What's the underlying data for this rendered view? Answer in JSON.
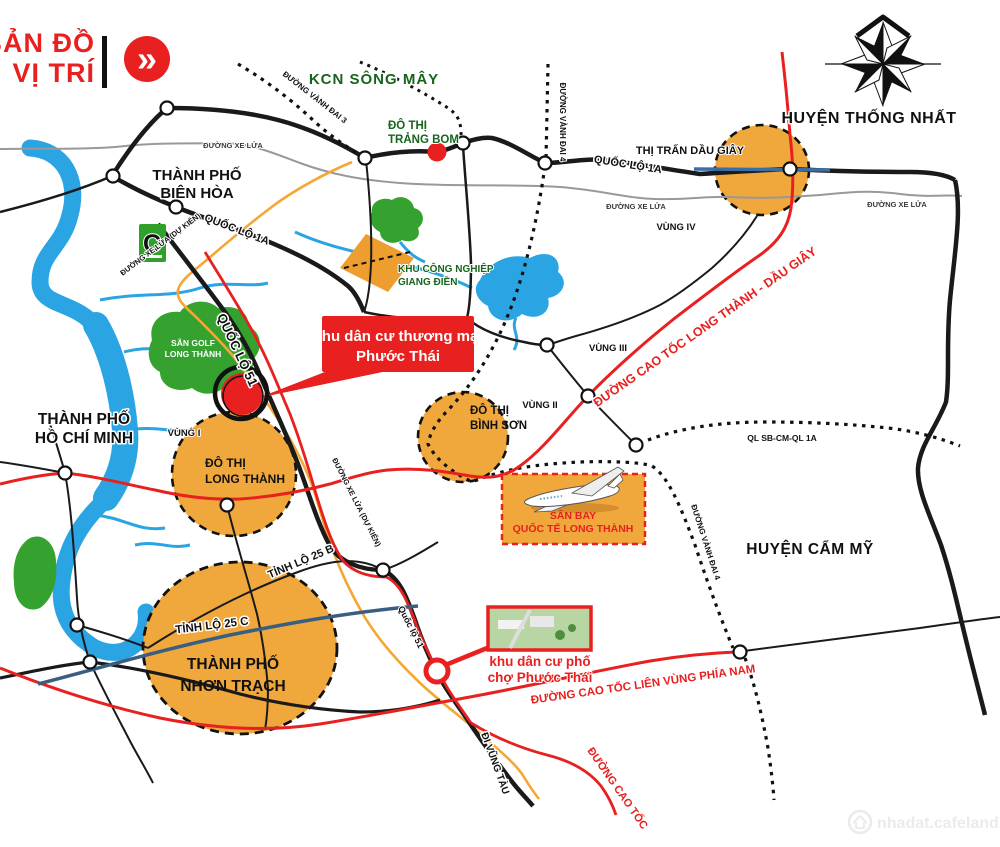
{
  "title": {
    "line1": "BẢN ĐỒ",
    "line2": "VỊ TRÍ",
    "chevron": "»"
  },
  "places": {
    "kcn_song_may": "KCN SÔNG MÂY",
    "do_thi_trang_bom_l1": "ĐÔ THỊ",
    "do_thi_trang_bom_l2": "TRẢNG BOM",
    "huyen_thong_nhat": "HUYỆN THỐNG NHẤT",
    "thi_tran_dau_giay": "THỊ TRẤN DẦU GIÂY",
    "tp_bien_hoa_l1": "THÀNH PHỐ",
    "tp_bien_hoa_l2": "BIÊN HÒA",
    "tp_hcm_l1": "THÀNH PHỐ",
    "tp_hcm_l2": "HỒ CHÍ MINH",
    "huyen_cam_my": "HUYỆN CẨM MỸ",
    "san_golf_l1": "SÂN GOLF",
    "san_golf_l2": "LONG THÀNH",
    "kcn_giang_dien_l1": "KHU CÔNG NGHIỆP",
    "kcn_giang_dien_l2": "GIANG ĐIỀN",
    "do_thi_binh_son_l1": "ĐÔ THỊ",
    "do_thi_binh_son_l2": "BÌNH SƠN",
    "do_thi_long_thanh_l1": "ĐÔ THỊ",
    "do_thi_long_thanh_l2": "LONG THÀNH",
    "tp_nhon_trach_l1": "THÀNH PHỐ",
    "tp_nhon_trach_l2": "NHƠN TRẠCH",
    "vung1": "VÙNG I",
    "vung2": "VÙNG II",
    "vung3": "VÙNG III",
    "vung4": "VÙNG IV",
    "bigc": "C"
  },
  "roads": {
    "ql1a": "QUỐC LỘ 1A",
    "ql51_big": "QUỐC LỘ 51",
    "ql51_small": "Quốc lộ 51",
    "tl25b": "TỈNH LỘ 25 B",
    "tl25c": "TỈNH LỘ 25 C",
    "vanh_dai_3": "ĐƯỜNG VÀNH ĐAI 3",
    "vanh_dai_4": "ĐƯỜNG VÀNH ĐAI 4",
    "xe_lua": "ĐƯỜNG XE LỬA",
    "xe_lua_du_kien": "ĐƯỜNG XE LỬA (DỰ KIẾN)",
    "ql_sb": "QL SB-CM-QL 1A",
    "cao_toc_ltdg": "ĐƯỜNG CAO TỐC LONG THÀNH - DẦU GIÂY",
    "cao_toc_lien_vung": "ĐƯỜNG CAO TỐC LIÊN VÙNG PHÍA NAM",
    "cao_toc": "ĐƯỜNG CAO TỐC",
    "di_vung_tau": "ĐI VŨNG TÀU"
  },
  "callouts": {
    "project_main_l1": "khu dân cư thương mại",
    "project_main_l2": "Phước Thái",
    "airport_l1": "SÂN BAY",
    "airport_l2": "QUỐC TẾ LONG THÀNH",
    "project_2_l1": "khu dân cư phố",
    "project_2_l2": "chợ Phước Thái"
  },
  "watermark": "nhadat.cafeland.vn",
  "colors": {
    "accent_red": "#E8201F",
    "orange_zone": "#F0A83C",
    "orange_industrial": "#EE9D2F",
    "green_area": "#35A22F",
    "dark_green_text": "#17641C",
    "water_blue": "#2BA4E4",
    "steel_blue": "#3B6EA5",
    "navy_road": "#3A5E80",
    "planned_rail_yellow": "#F5A733",
    "rail_gray": "#999999"
  }
}
